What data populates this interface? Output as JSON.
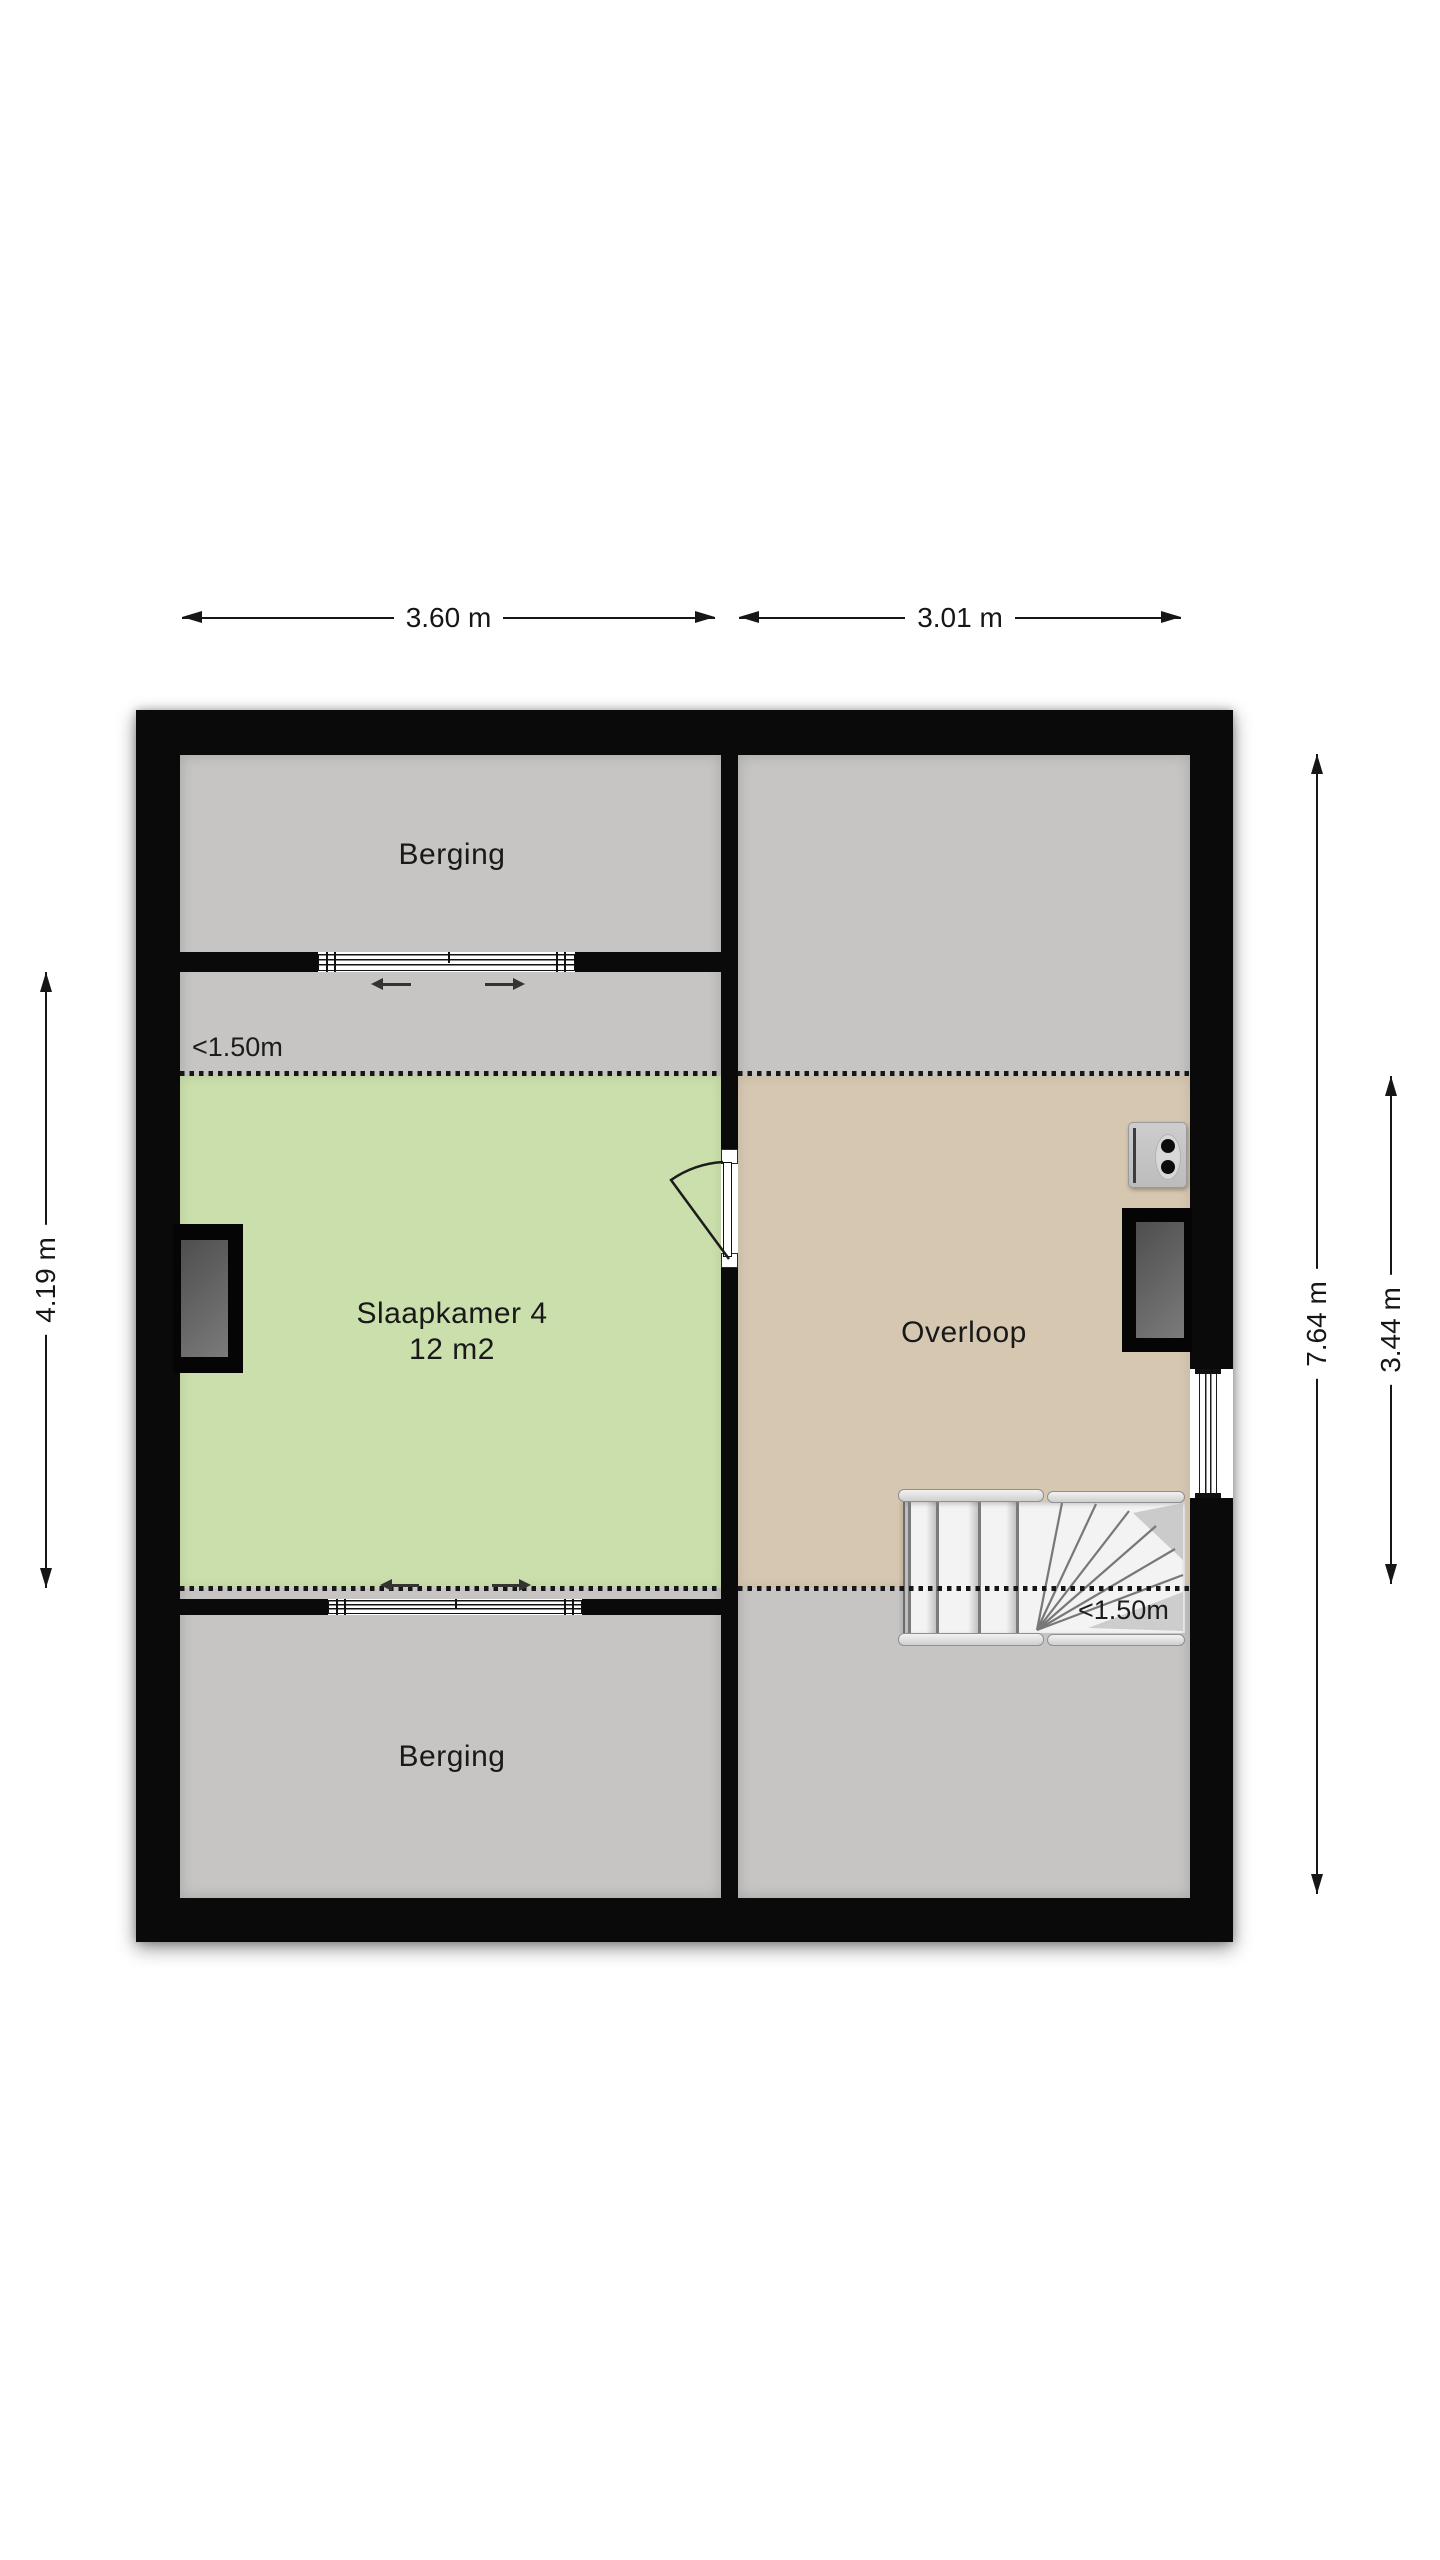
{
  "rooms": {
    "berging_top": {
      "label": "Berging"
    },
    "slaapkamer": {
      "label": "Slaapkamer 4",
      "area": "12 m2"
    },
    "overloop": {
      "label": "Overloop"
    },
    "berging_bottom": {
      "label": "Berging"
    }
  },
  "annotations": {
    "headroom_left": "<1.50m",
    "headroom_right": "<1.50m"
  },
  "dimensions": {
    "top_left": "3.60 m",
    "top_right": "3.01 m",
    "left": "4.19 m",
    "right_full": "7.64 m",
    "right_partial": "3.44 m"
  },
  "colors": {
    "wall": "#0a0a0a",
    "floor_gray": "#c6c5c3",
    "bedroom_green": "#cbdfac",
    "landing_tan": "#d6c7b1",
    "stairs_white": "#f3f3f3",
    "glass_dark": "#5c5c5c",
    "ink": "#161616"
  }
}
